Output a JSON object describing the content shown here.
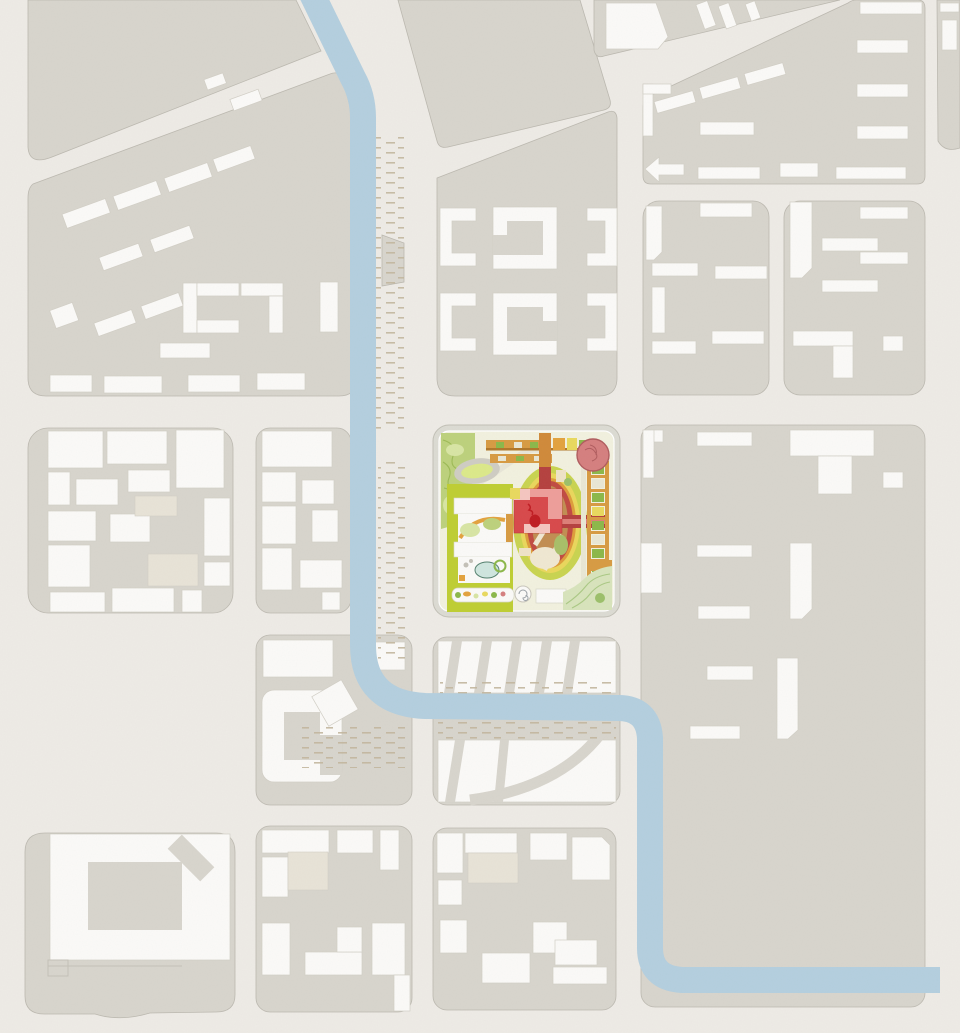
{
  "page": {
    "kind": "urban-masterplan-site-plan",
    "description": "Figure-ground city map with gray blocks, white building footprints, a canal, and a colorful campus site at center"
  },
  "features": {
    "river": "canal",
    "site": "campus-site",
    "site_elements": [
      "garden-landscape",
      "running-track",
      "trellis-canopies",
      "specimen-tree",
      "planted-colonnade",
      "stadium-oval",
      "main-red-building",
      "courtyard-gardens",
      "playground-strip",
      "spiral-plaza",
      "mint-garden"
    ],
    "city_block": "city-block",
    "building": "building-footprint",
    "beige_building": "low-building-footprint",
    "sand": "riverbank-planting-hatch"
  },
  "colors": {
    "bg": "#eeebe6",
    "block": "#d8d5cd",
    "block_outline": "#bcb9b0",
    "building": "#fbfaf8",
    "building_outline": "#d2cfc6",
    "building_beige": "#e8e3d7",
    "river": "#b4cfdf",
    "sand": "#c3b79e",
    "gray_detail": "#d8d5cd",
    "detail_line": "#c4c1b8",
    "site_wall": "#dcdbd3",
    "site_wall_edge": "#c2c0b6",
    "site_ground": "#f2f1df",
    "landscape_green": "#bdd17c",
    "landscape_contour": "#9cba55",
    "landscape_light": "#d8e5a4",
    "mint": "#d8e4bc",
    "mint_contour": "#abc985",
    "chartreuse": "#bfce33",
    "canopy_tan": "#d79b43",
    "canopy_dark": "#b0772a",
    "planter_green": "#8cb84a",
    "accent_yellow": "#e9d95e",
    "accent_orange": "#e3a23e",
    "ring_chartreuse": "#c9d450",
    "ring_yellow": "#ead75c",
    "ring_orange": "#de9d3b",
    "ring_red": "#c14b42",
    "field_tan": "#c28e52",
    "field_path": "#f0e8d2",
    "field_green": "#a8bf68",
    "field_cream": "#efe3c8",
    "tree_small": "#9cc06a",
    "building_red": "#d8494b",
    "building_pink": "#ee9e9a",
    "building_pink_light": "#f5c6c0",
    "building_red_dark": "#c01c22",
    "bar_red": "#b5413f",
    "bar_red_light": "#dd7f78",
    "bar_orange": "#d08a3a",
    "tree_pink": "#d57f7f",
    "tree_outline": "#b05c5e",
    "pond": "#cfe6df",
    "pond_outline": "#54806e",
    "track_ring": "#cfcdc3",
    "track_infield": "#dce98a",
    "path_light": "#e8e6d8",
    "cell_cream": "#e9e7d5"
  }
}
